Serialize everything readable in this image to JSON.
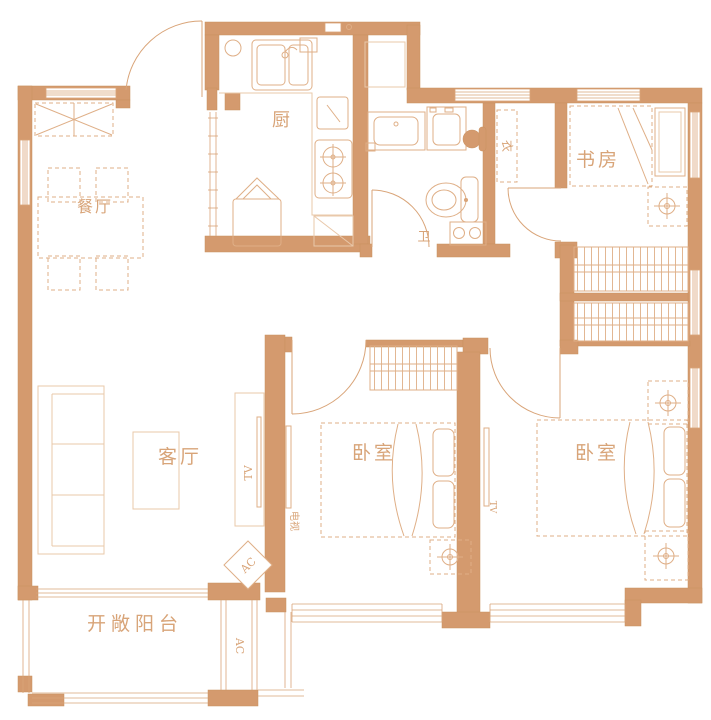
{
  "colors": {
    "wall": "#D49A6E",
    "line": "#D9A478",
    "furniture_light": "#E9C8AA",
    "furniture_medium": "#DFAF87",
    "label_text": "#D8A478",
    "background": "#FFFFFF"
  },
  "rooms": {
    "dining": {
      "label": "餐厅"
    },
    "kitchen": {
      "label": "厨"
    },
    "bathroom": {
      "label": "卫"
    },
    "study": {
      "label": "书房"
    },
    "living": {
      "label": "客厅"
    },
    "bedroom_middle": {
      "label": "卧室"
    },
    "bedroom_right": {
      "label": "卧室"
    },
    "balcony": {
      "label": "开敞阳台"
    }
  },
  "annotations": {
    "closet": "衣",
    "tv_living": "TV",
    "tv_bedroom_middle": "电视",
    "tv_bedroom_right": "TV",
    "ac_corner": "AC",
    "ac_shaft": "AC"
  }
}
